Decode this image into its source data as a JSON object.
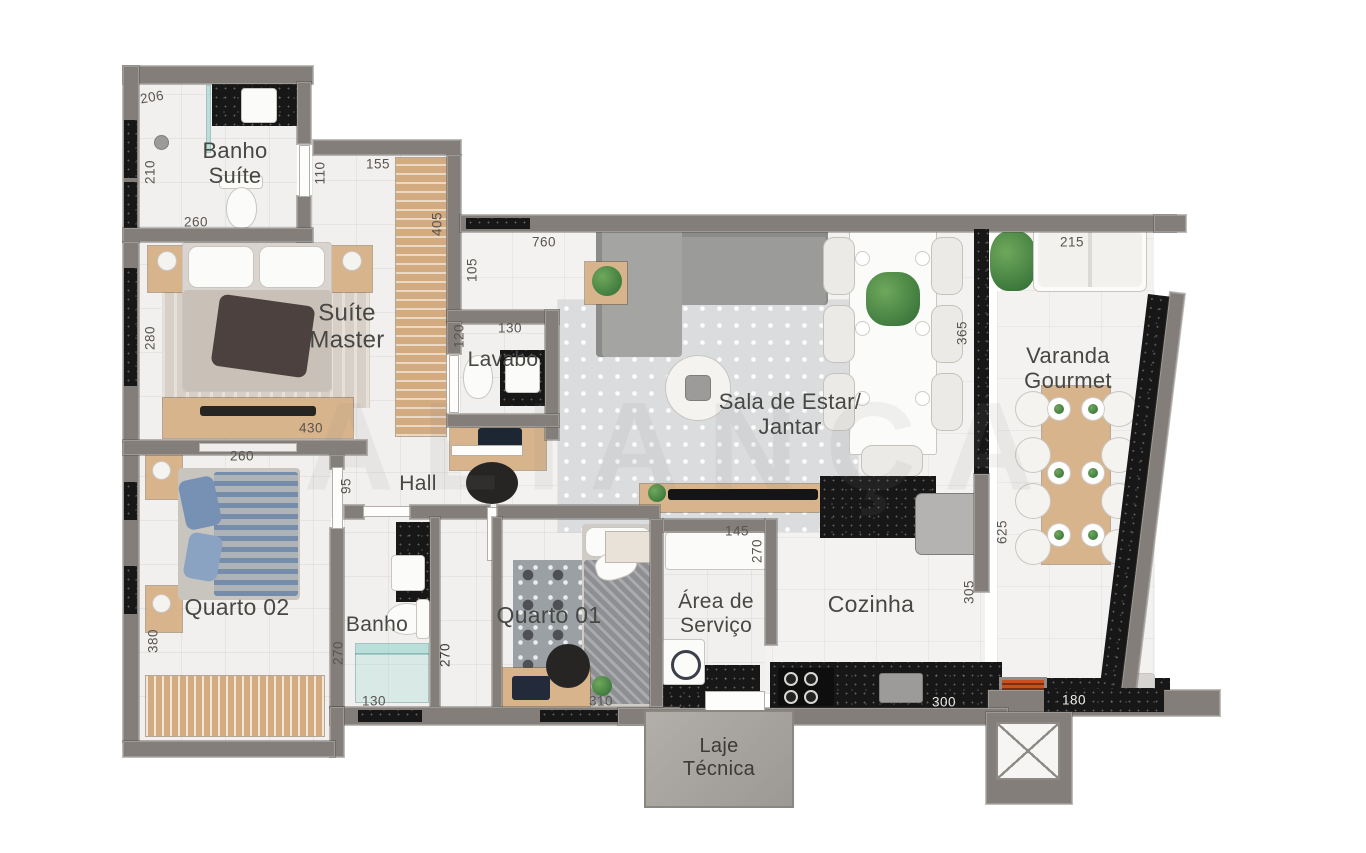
{
  "title": "Planta do apartamento",
  "watermark": "ALIANÇA",
  "rooms": {
    "banho_suite": "Banho\nSuíte",
    "suite_master": "Suíte\nMaster",
    "lavabo": "Lavabo",
    "hall": "Hall",
    "sala": "Sala de Estar/\nJantar",
    "varanda": "Varanda\nGourmet",
    "quarto02": "Quarto 02",
    "banho": "Banho",
    "quarto01": "Quarto 01",
    "area_servico": "Área de\nServiço",
    "cozinha": "Cozinha",
    "laje": "Laje\nTécnica"
  },
  "dims": {
    "d206": "206",
    "d210": "210",
    "d260a": "260",
    "d155": "155",
    "d110": "110",
    "d405": "405",
    "d105": "105",
    "d760": "760",
    "d120": "120",
    "d130a": "130",
    "d280": "280",
    "d430": "430",
    "d260b": "260",
    "d95": "95",
    "d365": "365",
    "d215": "215",
    "d625": "625",
    "d305": "305",
    "d270a": "270",
    "d380": "380",
    "d130b": "130",
    "d270b": "270",
    "d310": "310",
    "d145": "145",
    "d270c": "270",
    "d300": "300",
    "d180": "180"
  },
  "colors": {
    "wall": "#837e79",
    "granite": "#171717",
    "wood": "#d2ab80",
    "floor": "#f1f0ee",
    "glass": "#96d2cb",
    "grill_accent": "#c8501c"
  }
}
